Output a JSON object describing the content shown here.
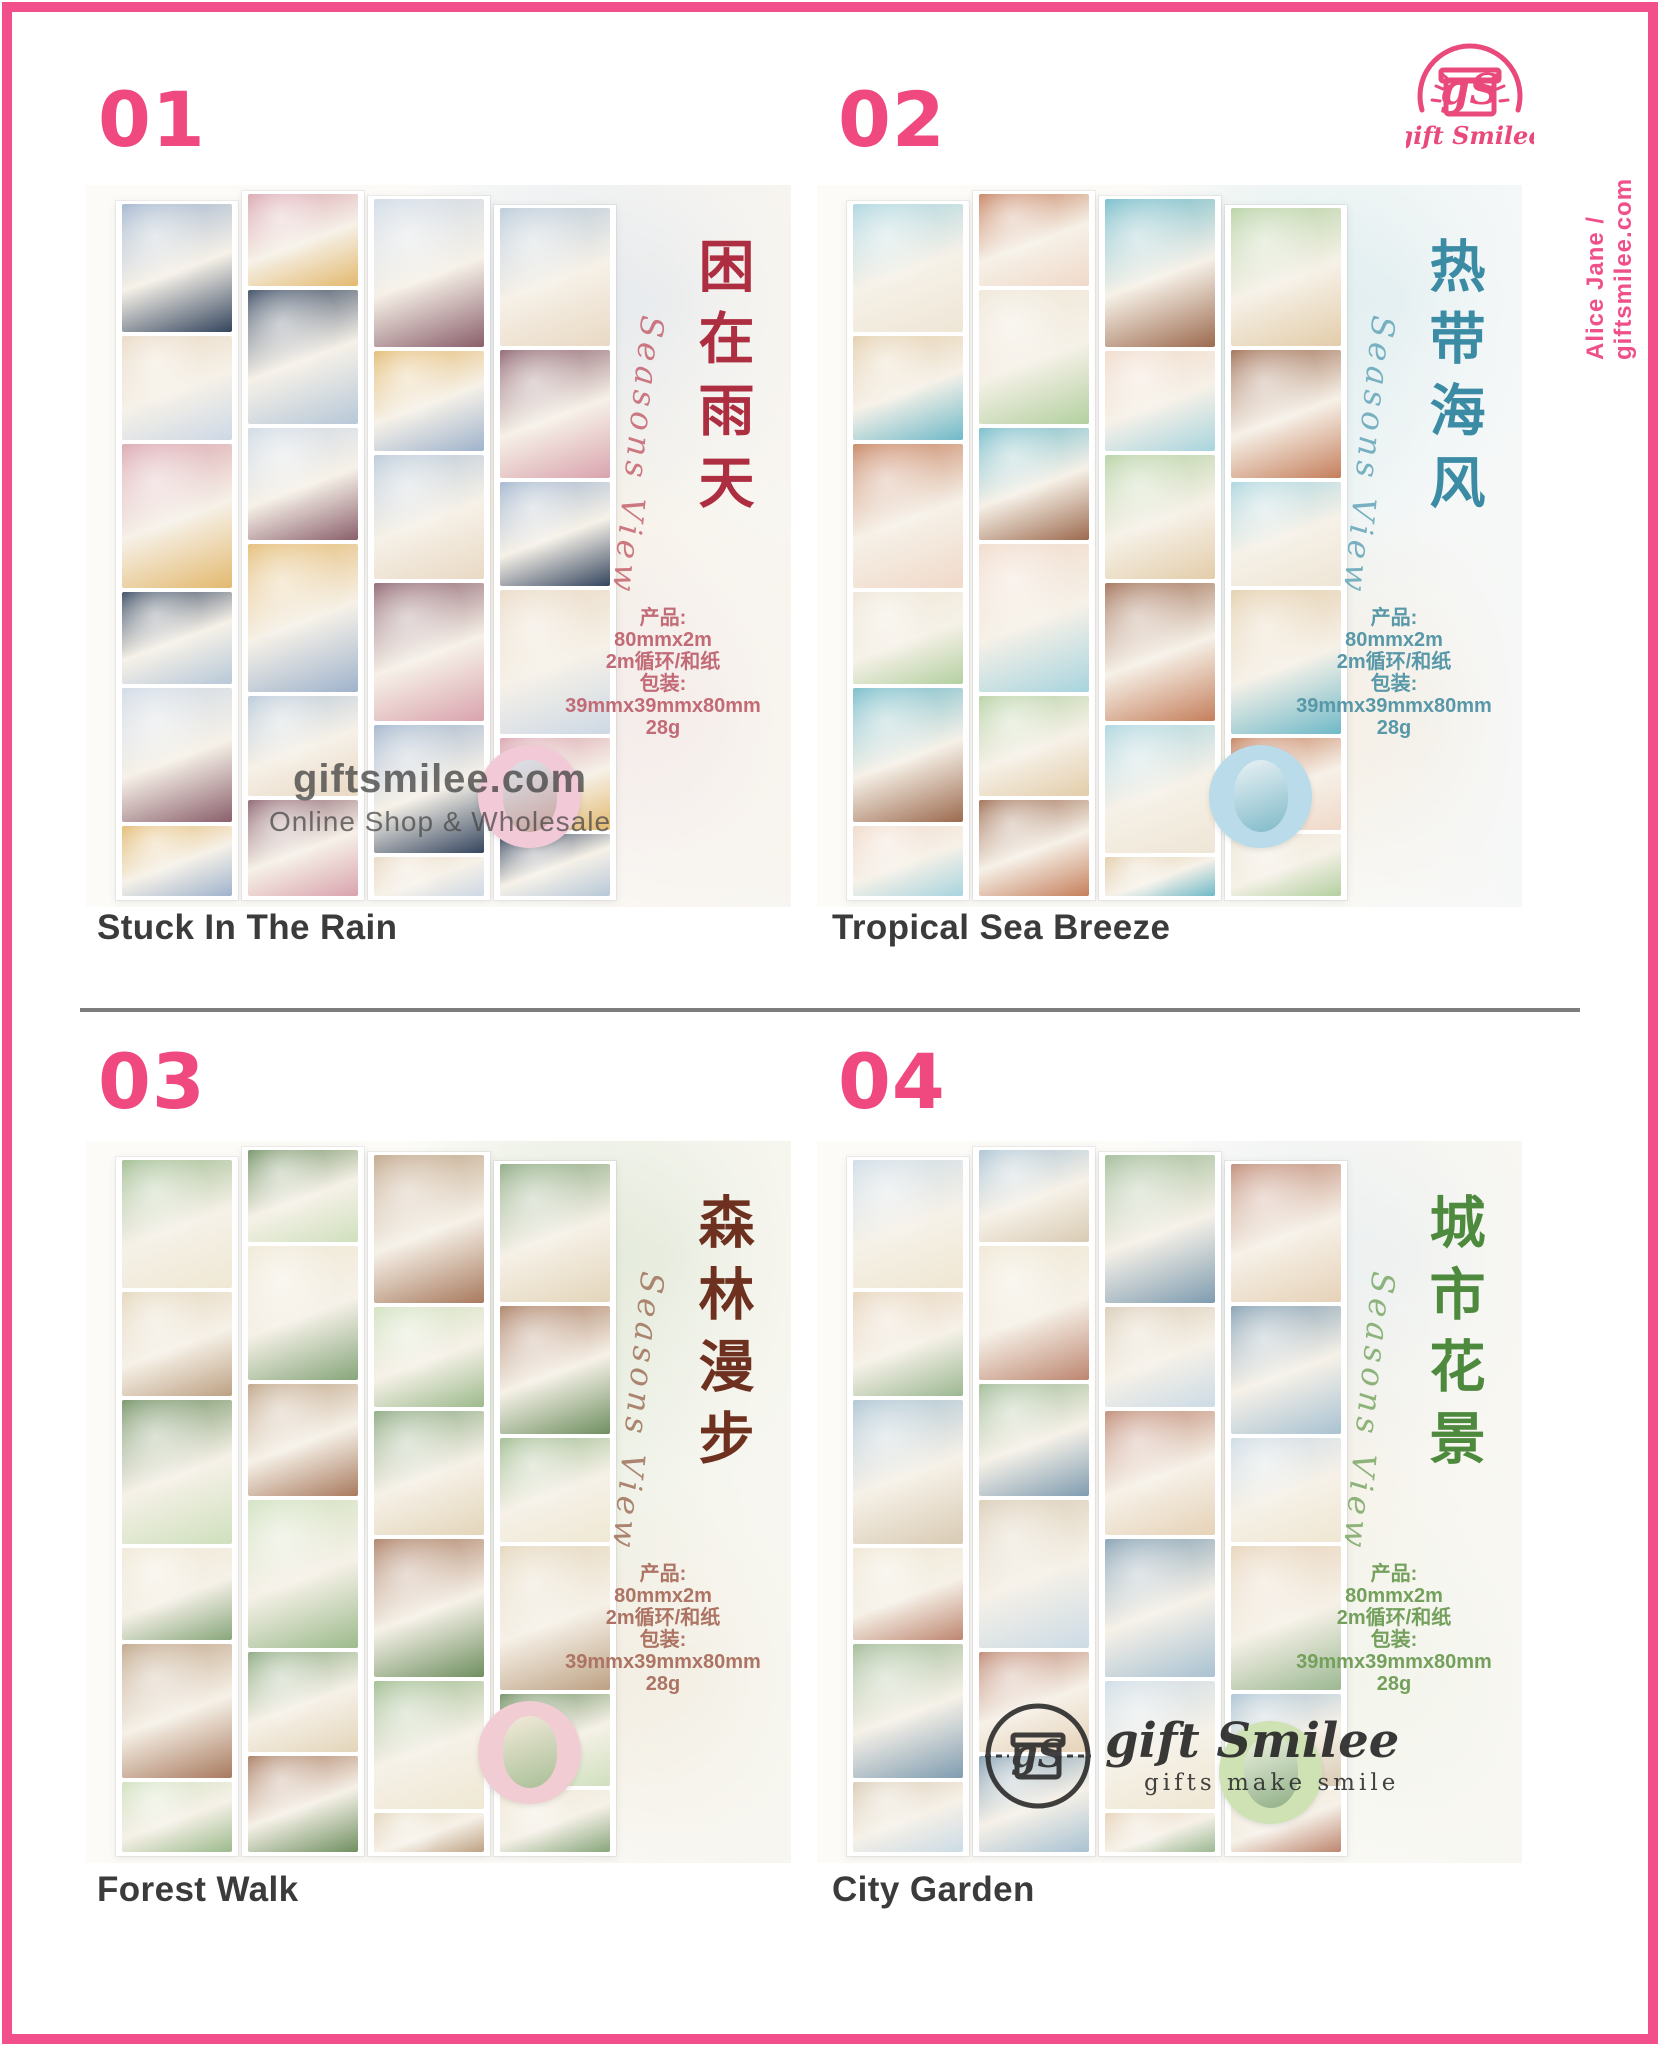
{
  "page": {
    "accent_pink": "#f1508a",
    "title_color": "#3b3b3b",
    "divider_color": "#7d7d7d",
    "side_credit": "Alice Jane / giftsmilee.com",
    "brand": {
      "name": "gift Smilee",
      "icon": "gift-box-icon"
    }
  },
  "watermarks": {
    "domain": "giftsmilee.com",
    "subtitle": "Online Shop & Wholesale",
    "brand": "gift Smilee",
    "tagline": "gifts make smile"
  },
  "specs": {
    "product_label": "产品:",
    "tape_size": "80mmx2m",
    "material": "2m循环/和纸",
    "packaging_label": "包装:",
    "package_size": "39mmx39mmx80mm",
    "weight": "28g"
  },
  "products": [
    {
      "number": "01",
      "title": "Stuck In The Rain",
      "calligraphy": "困在雨天",
      "script": "Seasons View",
      "calligraphy_color": "#ad2e40",
      "script_color": "#c25a66",
      "specs_color": "#c26b76",
      "palette": [
        "#9fb3cc",
        "#e9d9c4",
        "#d9a3ad",
        "#34455e",
        "#cdd8e5",
        "#e3b96f",
        "#b7c8d8",
        "#8a5f6b"
      ]
    },
    {
      "number": "02",
      "title": "Tropical Sea Breeze",
      "calligraphy": "热带海风",
      "script": "Seasons View",
      "calligraphy_color": "#3c8ba4",
      "script_color": "#5ba0b5",
      "specs_color": "#5898a8",
      "palette": [
        "#a8d4de",
        "#e3cdaa",
        "#c57f5c",
        "#eee6d6",
        "#6fb9c8",
        "#f0d9c9",
        "#b3d0a0",
        "#9c6a4e"
      ]
    },
    {
      "number": "03",
      "title": "Forest Walk",
      "calligraphy": "森林漫步",
      "script": "Seasons View",
      "calligraphy_color": "#6e3120",
      "script_color": "#9a6a52",
      "specs_color": "#ad7464",
      "palette": [
        "#9cba8c",
        "#e3d5ba",
        "#6f8f60",
        "#efe8d4",
        "#bda183",
        "#cfe0bd",
        "#87a67b",
        "#a87a5e"
      ]
    },
    {
      "number": "04",
      "title": "City Garden",
      "calligraphy": "城市花景",
      "script": "Seasons View",
      "calligraphy_color": "#4e8a3e",
      "script_color": "#74a45f",
      "specs_color": "#74a05c",
      "palette": [
        "#ccdbe5",
        "#e6d2b8",
        "#a9c2d2",
        "#efe7d3",
        "#9cb892",
        "#d9cbb4",
        "#bd8670",
        "#7f9cb0"
      ]
    }
  ]
}
